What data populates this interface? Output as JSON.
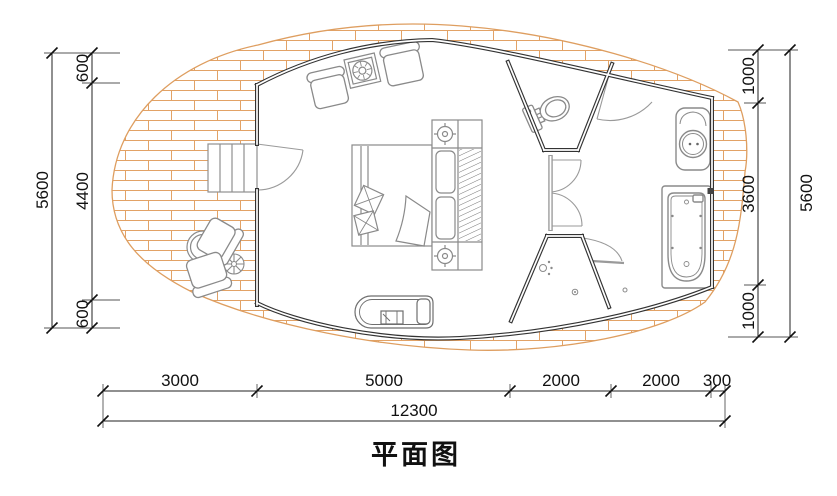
{
  "title": "平面图",
  "colors": {
    "deck_line": "#de9e60",
    "wall": "#333333",
    "partition": "#9a9a9a",
    "furniture": "#8a8a8a",
    "dimension": "#1a1a1a",
    "background": "#ffffff"
  },
  "dimensions": {
    "left": {
      "segments": [
        "600",
        "4400",
        "600"
      ],
      "total": "5600"
    },
    "right": {
      "segments": [
        "1000",
        "3600",
        "1000"
      ],
      "total": "5600"
    },
    "bottom": {
      "segments": [
        "3000",
        "5000",
        "2000",
        "2000",
        "300"
      ],
      "total": "12300"
    }
  },
  "symbols": [
    "wood-deck",
    "stairs",
    "armchair",
    "side-table",
    "round-table",
    "parasol-table",
    "outdoor-chair",
    "double-bed",
    "pillow",
    "cushion",
    "nightstand",
    "table-lamp",
    "headboard",
    "bench",
    "toilet",
    "washbasin",
    "bathtub",
    "shower-drain",
    "shower-head",
    "door-swing"
  ]
}
